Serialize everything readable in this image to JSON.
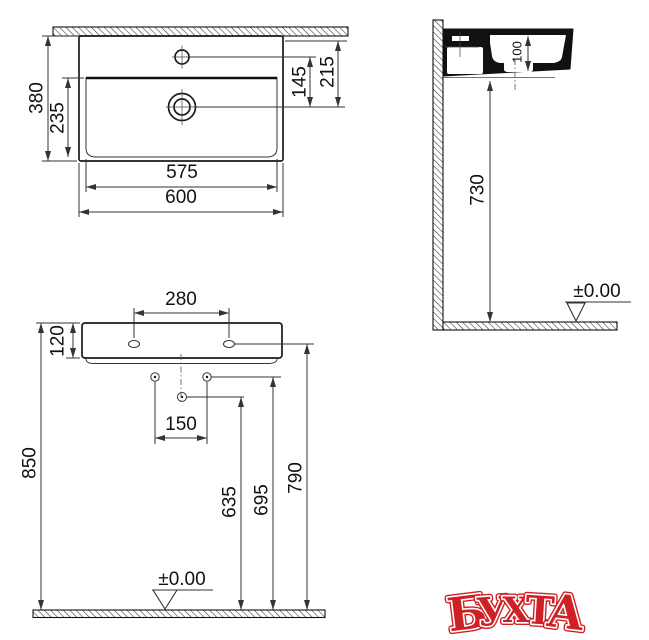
{
  "drawing": {
    "plan_view": {
      "depth_total": "380",
      "depth_basin": "235",
      "width_basin": "575",
      "width_total": "600",
      "faucet_to_drain": "145",
      "back_to_drain": "215"
    },
    "side_view": {
      "basin_inner_depth": "100",
      "floor_to_underside": "730",
      "datum_level": "±0.00"
    },
    "front_view": {
      "mounting_hole_spacing": "280",
      "apron_height": "120",
      "fixing_hole_spacing": "150",
      "height_total": "850",
      "height_635": "635",
      "height_695": "695",
      "height_790": "790",
      "datum_level": "±0.00"
    }
  },
  "watermark": {
    "text": "БУХТА",
    "letters": [
      "Б",
      "У",
      "Х",
      "Т",
      "А"
    ],
    "color": "#cf2026"
  },
  "colors": {
    "line": "#1a1a1a",
    "watermark_red": "#cf2026"
  }
}
